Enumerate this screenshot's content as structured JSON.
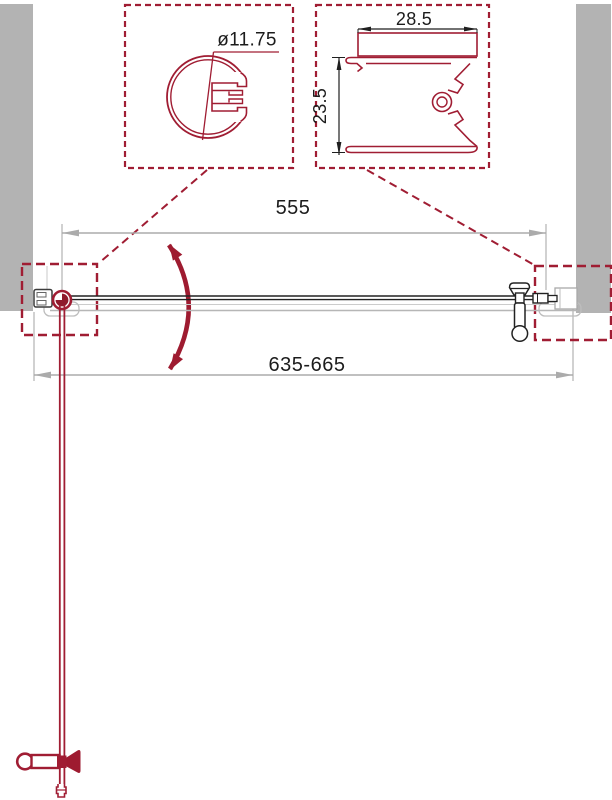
{
  "drawing": {
    "dimensions": {
      "door_width": "555",
      "overall_width": "635-665"
    },
    "detail_circle_profile": {
      "diameter": "ø11.75"
    },
    "detail_wall_profile": {
      "width": "28.5",
      "depth": "23.5"
    },
    "colors": {
      "accent_red": "#a01d33",
      "arc_red": "#9e1b30",
      "wall_gray": "#b3b3b3",
      "dim_gray": "#ababab",
      "ink_black": "#1f1f1f"
    }
  }
}
